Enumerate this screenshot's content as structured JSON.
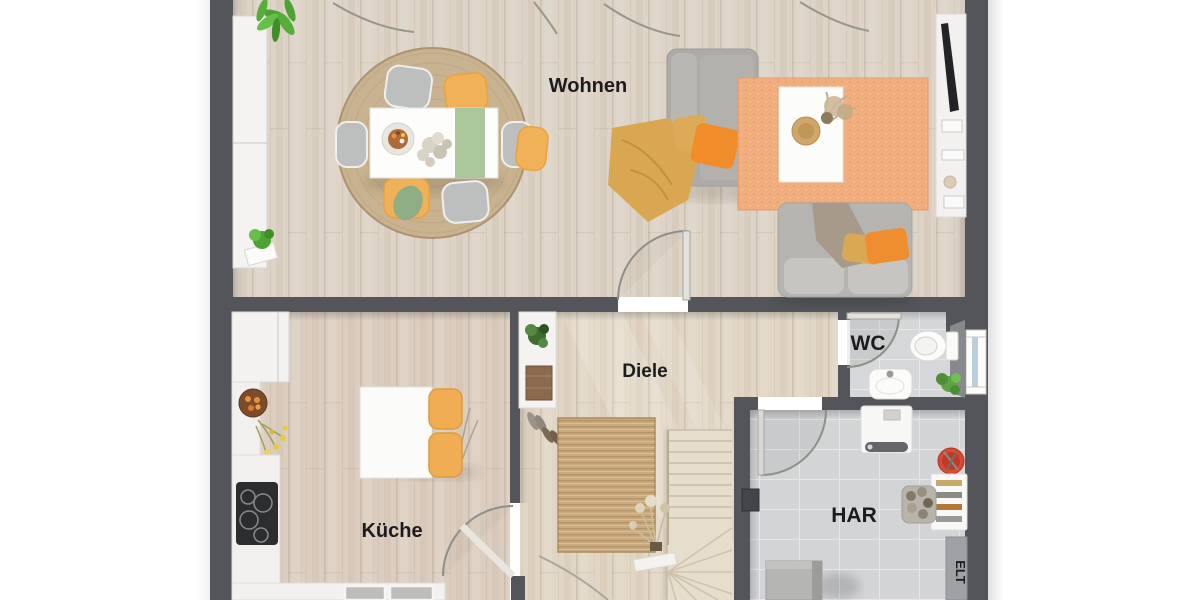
{
  "floorplan": {
    "rooms": {
      "living": {
        "label": "Wohnen"
      },
      "kitchen": {
        "label": "Küche"
      },
      "hallway": {
        "label": "Diele"
      },
      "wc": {
        "label": "WC"
      },
      "utility": {
        "label": "HAR"
      },
      "electrical": {
        "label": "ELT"
      }
    },
    "colors": {
      "wall": "#53555a",
      "wood_living": "#ddd3c6",
      "wood_kitchen": "#dbcec0",
      "wood_hall": "#e1d6c6",
      "tile": "#d6d7d9",
      "rug_round_jute": "#c8b28f",
      "rug_runner_jute": "#c9a97e",
      "rug_living_orange": "#f0ad7d",
      "sofa_gray": "#b2b1ad",
      "chair_yellow": "#f1b158",
      "table_runner_green": "#a9c79b",
      "pillow_orange": "#f18c2b",
      "blanket_yellow": "#d9a751",
      "counter_white": "#f2f1ef",
      "cooktop_black": "#2c2d2f",
      "bucket_red": "#d84b33",
      "plant_green": "#55ae3a",
      "label_text": "#1c1c1e"
    }
  }
}
